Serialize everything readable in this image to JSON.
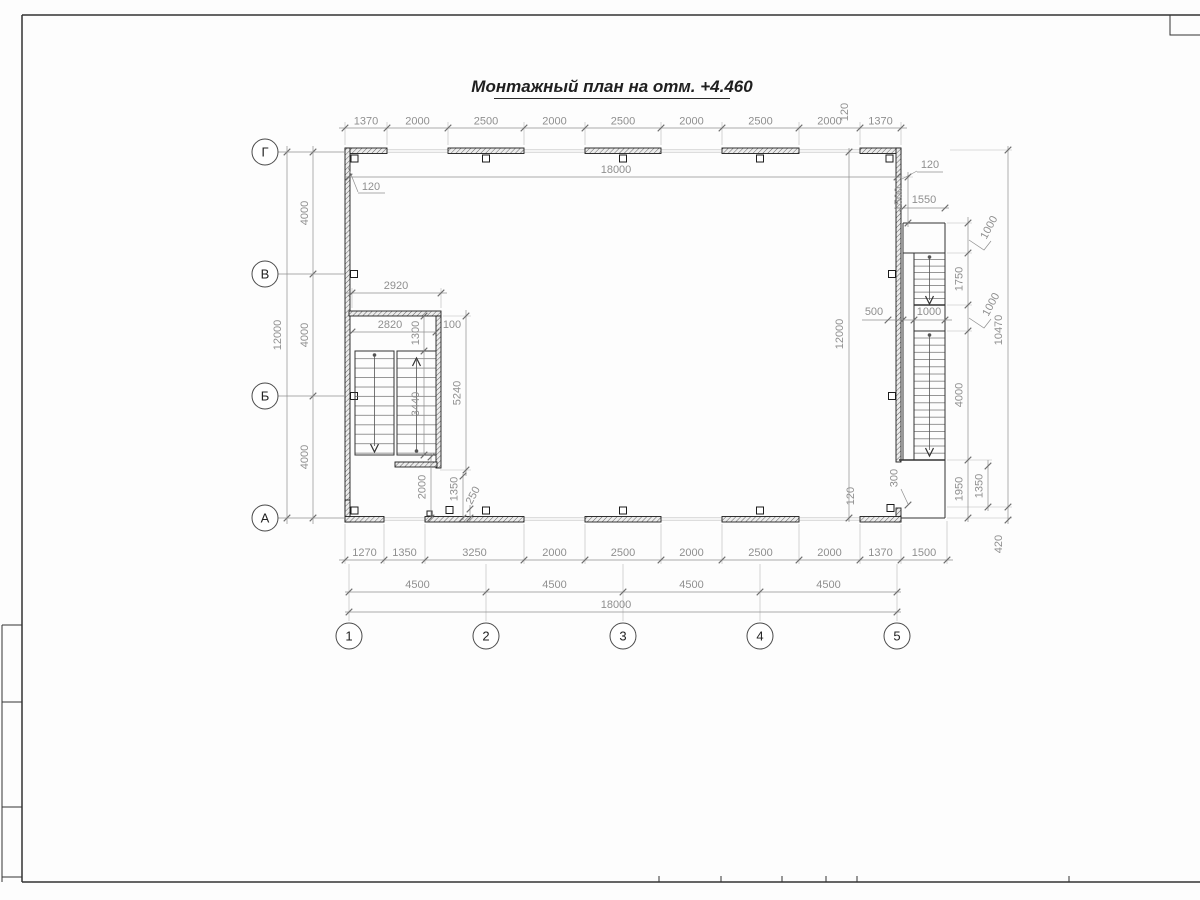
{
  "title": "Монтажный план на отм. +4.460",
  "grid": {
    "rows": [
      "Г",
      "В",
      "Б",
      "А"
    ],
    "cols": [
      "1",
      "2",
      "3",
      "4",
      "5"
    ]
  },
  "dims": {
    "top_chain": [
      "1370",
      "2000",
      "2500",
      "2000",
      "2500",
      "2000",
      "2500",
      "2000",
      "1370"
    ],
    "bottom_chain": [
      "1270",
      "1350",
      "3250",
      "2000",
      "2500",
      "2000",
      "2500",
      "2000",
      "1370",
      "1500"
    ],
    "bottom_spans": [
      "4500",
      "4500",
      "4500",
      "4500"
    ],
    "total_width": "18000",
    "total_height": "12000",
    "row_span": "4000",
    "wall_offset": "120",
    "stair_left": {
      "width_outer": "2920",
      "width_inner": "2820",
      "flight_width": "1300",
      "flight_gap": "100",
      "flight_length": "3440",
      "well_length": "5240",
      "below_gap": "2000",
      "door_offset": "1350",
      "door_gap": "250"
    },
    "stair_right": {
      "top_offset": "1500",
      "top_width": "1550",
      "landing_top": "1000",
      "flight1": "1750",
      "landing_mid": "1000",
      "flight_width": "1000",
      "side_gap": "500",
      "flight2": "4000",
      "landing_bottom": "1950",
      "strip": "300",
      "ext_upper": "1350",
      "ext_lower": "420",
      "total": "10470"
    }
  }
}
